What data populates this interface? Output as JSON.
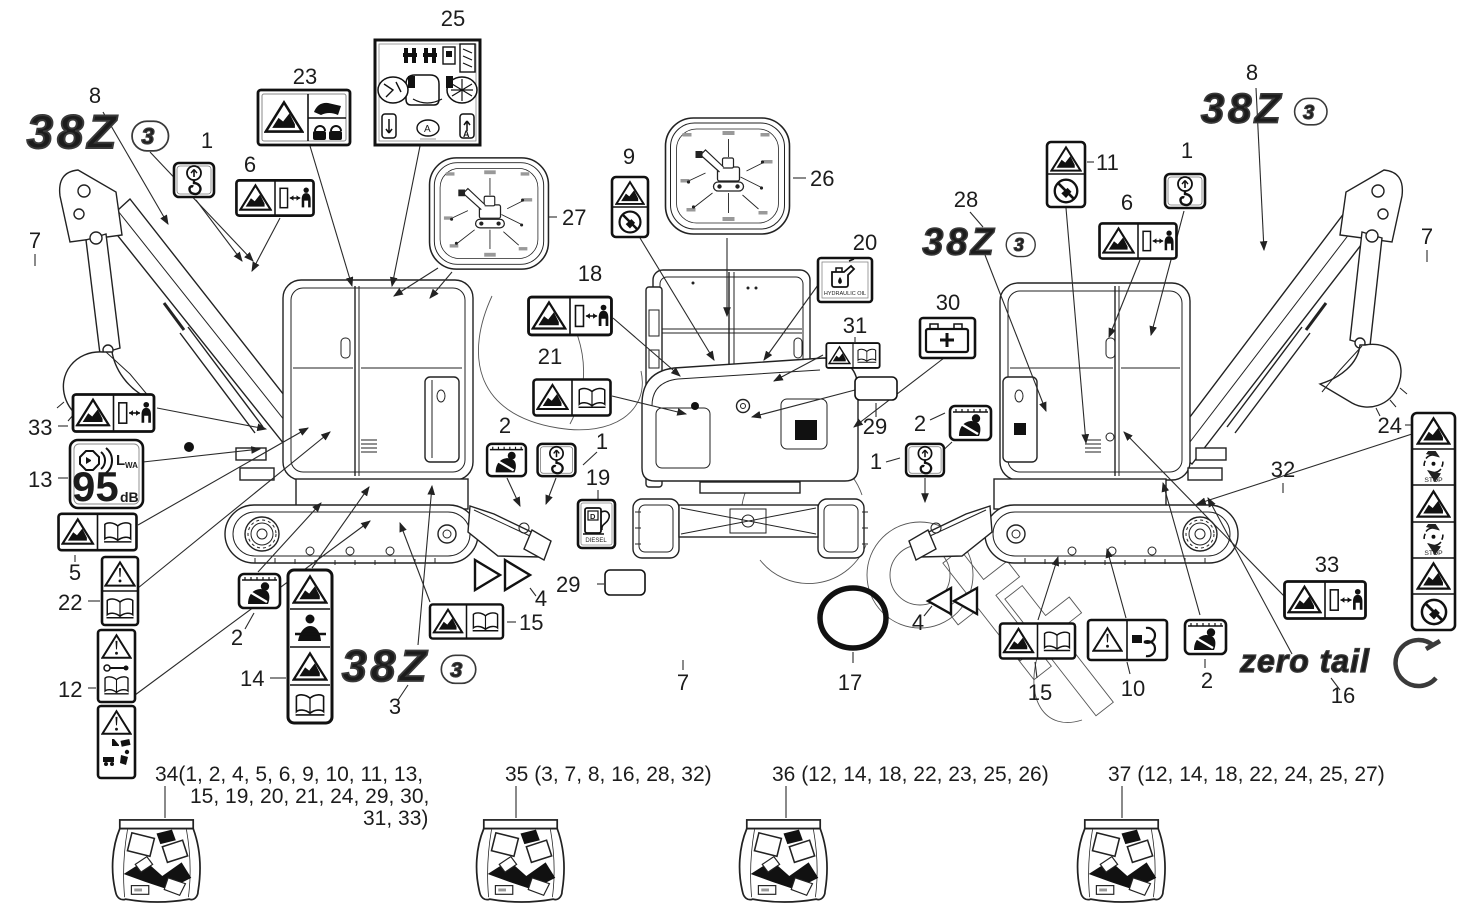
{
  "diagram": {
    "subject": "mini excavator decal location diagram",
    "model": "38Z3"
  },
  "logos": {
    "model_main": "38Z",
    "model_badge": "3",
    "zero_tail": "zero tail"
  },
  "labels": {
    "hydraulic_oil": "HYDRAULIC OIL",
    "diesel": "DIESEL",
    "diesel_d": "D",
    "stop": "STOP",
    "lwa_l": "L",
    "lwa_wa": "WA",
    "db_value": "95",
    "db_unit": "dB",
    "a_mark": "A"
  },
  "callouts": {
    "n1": "1",
    "n2": "2",
    "n3": "3",
    "n4": "4",
    "n5": "5",
    "n6": "6",
    "n7": "7",
    "n8": "8",
    "n9": "9",
    "n10": "10",
    "n11": "11",
    "n12": "12",
    "n13": "13",
    "n14": "14",
    "n15": "15",
    "n16": "16",
    "n17": "17",
    "n18": "18",
    "n19": "19",
    "n20": "20",
    "n21": "21",
    "n22": "22",
    "n23": "23",
    "n24": "24",
    "n25": "25",
    "n26": "26",
    "n27": "27",
    "n28": "28",
    "n29": "29",
    "n30": "30",
    "n31": "31",
    "n32": "32",
    "n33": "33"
  },
  "bags": {
    "b34": {
      "lines": [
        "34(1, 2, 4, 5, 6, 9, 10, 11, 13,",
        "15, 19, 20, 21, 24, 29, 30,",
        "31, 33)"
      ]
    },
    "b35": {
      "lines": [
        "35 (3, 7, 8, 16, 28, 32)"
      ]
    },
    "b36": {
      "lines": [
        "36 (12, 14, 18, 22, 23, 25, 26)"
      ]
    },
    "b37": {
      "lines": [
        "37 (12, 14, 18, 22, 24, 25, 27)"
      ]
    }
  }
}
